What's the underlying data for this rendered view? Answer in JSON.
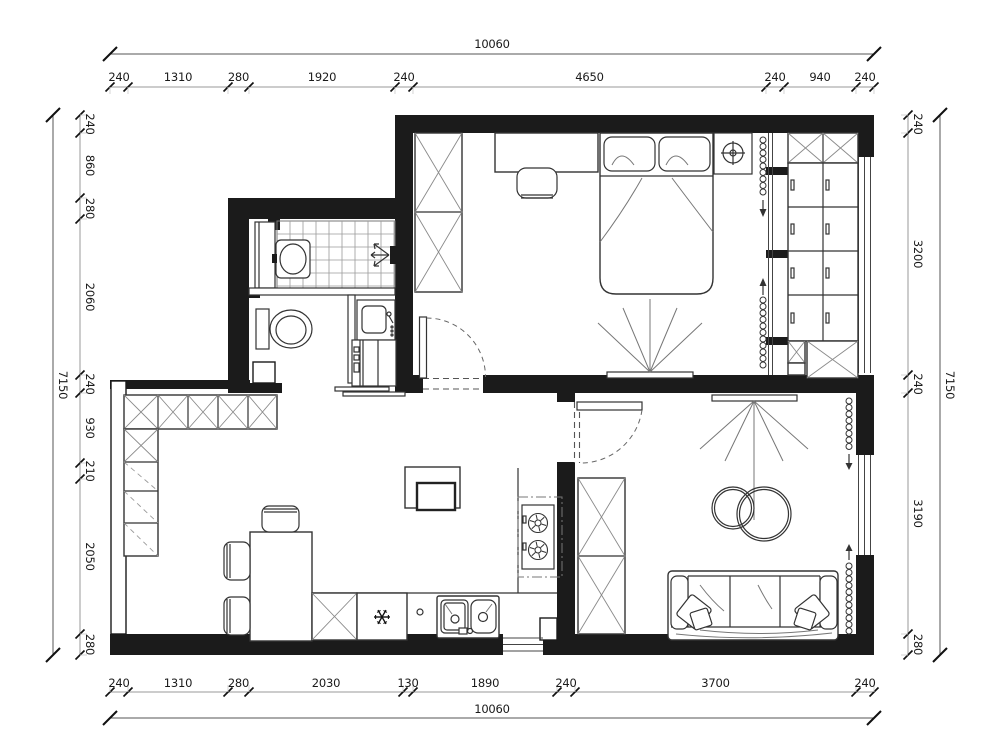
{
  "canvas": {
    "width": 1000,
    "height": 753,
    "background": "#ffffff",
    "wall_color": "#1b1b1b",
    "furniture_line_color": "#333333",
    "dim_line_color": "#999999",
    "dim_tick_color": "#111111",
    "dim_text_color": "#1a1a1a"
  },
  "dimensions": {
    "top": {
      "total": "10060",
      "segments": [
        "240",
        "1310",
        "280",
        "1920",
        "240",
        "4650",
        "240",
        "940",
        "240"
      ]
    },
    "bottom": {
      "total": "10060",
      "segments": [
        "240",
        "1310",
        "280",
        "2030",
        "130",
        "1890",
        "240",
        "3700",
        "240"
      ]
    },
    "left": {
      "total": "7150",
      "segments": [
        "240",
        "860",
        "280",
        "2060",
        "240",
        "930",
        "210",
        "2050",
        "280"
      ]
    },
    "right": {
      "total": "7150",
      "segments": [
        "240",
        "3200",
        "240",
        "3190",
        "280"
      ]
    }
  },
  "rooms": [
    {
      "name": "bedroom"
    },
    {
      "name": "bathroom"
    },
    {
      "name": "kitchen-dining"
    },
    {
      "name": "living-room"
    },
    {
      "name": "storage-closet"
    }
  ],
  "fixtures": [
    "wardrobe-icon",
    "desk-icon",
    "desk-chair-icon",
    "double-bed-icon",
    "nightstand-lamp-icon",
    "tv-icon",
    "curtain-icon",
    "shower-icon",
    "wash-basin-icon",
    "toilet-icon",
    "vanity-sink-icon",
    "washing-machine-icon",
    "dining-table-icon",
    "dining-chair-icon",
    "kitchen-cabinet-icon",
    "refrigerator-icon",
    "double-sink-icon",
    "cooktop-icon",
    "sofa-icon",
    "coffee-table-icon",
    "door-swing-icon",
    "window-icon"
  ]
}
